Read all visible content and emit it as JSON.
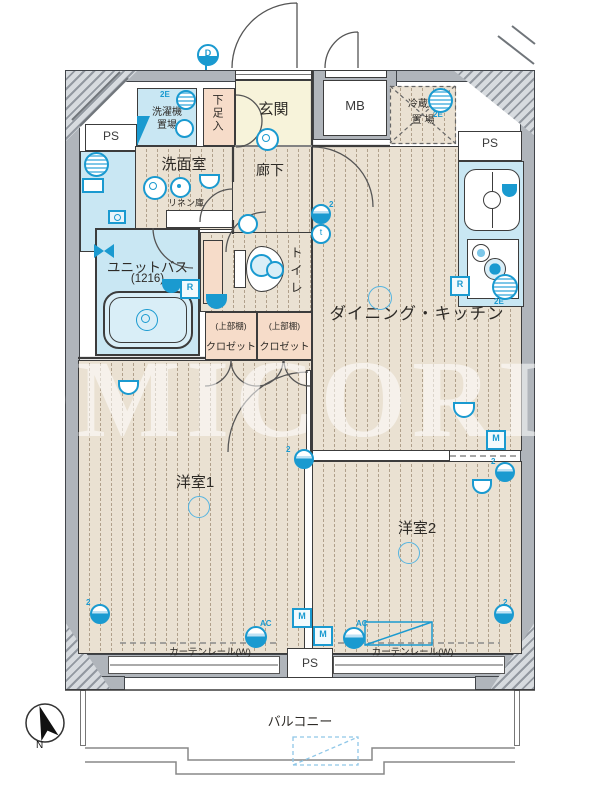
{
  "plan": {
    "watermark": "OMICORI",
    "compass": {
      "north_label": "N"
    },
    "rooms": {
      "entrance": "玄関",
      "shoe_box": "下足入",
      "laundry_line1": "洗濯機",
      "laundry_line2": "置場",
      "washroom": "洗面室",
      "linen_closet": "リネン庫",
      "hallway": "廊下",
      "meter_box": "MB",
      "pipe_space": "PS",
      "fridge_line1": "冷蔵庫",
      "fridge_line2": "置 場",
      "unit_bath_line1": "ユニットバス",
      "unit_bath_line2": "(1216)",
      "toilet": "トイレ",
      "closet_shelf_note": "(上部棚)",
      "closet": "クロゼット",
      "dining_kitchen": "ダイニング・キッチン",
      "bedroom1": "洋室1",
      "bedroom2": "洋室2",
      "curtain_rail": "カーテンレール(W)",
      "balcony": "バルコニー"
    },
    "symbols": {
      "refrigerant": "R",
      "meter": "M",
      "phone": "t",
      "air_con": "AC",
      "doorbell": "D",
      "outlet_count": "2",
      "tag_2e": "2E"
    },
    "colors": {
      "icon_blue": "#1a9ad0",
      "floor_beige": "#eae1d2",
      "fixture_blue": "#c9e7f3",
      "entrance_cream": "#f7f3da",
      "closet_pink": "#f6dcc9",
      "wall_gray": "#b0b5bb"
    }
  }
}
